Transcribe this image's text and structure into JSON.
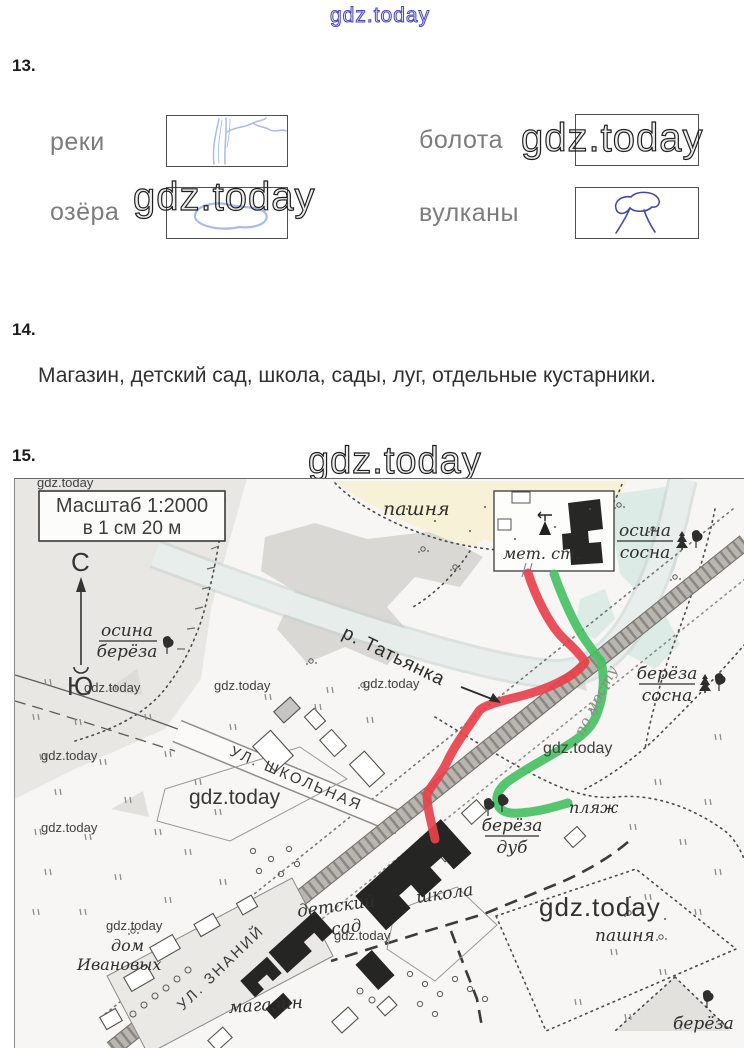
{
  "page": {
    "watermark": "gdz.today"
  },
  "tasks": {
    "t13": {
      "number": "13.",
      "rows": [
        {
          "left_label": "реки",
          "right_label": "болота"
        },
        {
          "left_label": "озёра",
          "right_label": "вулканы"
        }
      ]
    },
    "t14": {
      "number": "14.",
      "answer": "Магазин, детский сад, школа, сады, луг, отдельные кустарники."
    },
    "t15": {
      "number": "15."
    }
  },
  "map": {
    "scale_line1": "Масштаб 1:2000",
    "scale_line2": "в 1 см 20 м",
    "compass": {
      "north": "С",
      "south": "Ю"
    },
    "legends": {
      "osina_bereza": {
        "top": "осина",
        "bottom": "берёза"
      },
      "osina_sosna": {
        "top": "осина",
        "bottom": "сосна"
      },
      "bereza_sosna": {
        "top": "берёза",
        "bottom": "сосна"
      },
      "bereza_dub": {
        "top": "берёза",
        "bottom": "дуб"
      },
      "bereza_corner": "берёза"
    },
    "labels": {
      "pashnya_top": "пашня",
      "pashnya_bottom": "пашня",
      "river": "р. Татьянка",
      "met_st": "мет. ст.",
      "beach": "пляж",
      "school": "школа",
      "kindergarten_1": "детский",
      "kindergarten_2": "сад",
      "shop": "магазин",
      "house_1": "дом",
      "house_2": "Ивановых",
      "street_shkolnaya": "УЛ. ШКОЛЬНАЯ",
      "street_znaniy": "УЛ. ЗНАНИЙ",
      "route_note": "по мосту"
    },
    "colors": {
      "route_red": "#e8414b",
      "route_green": "#46c163"
    }
  }
}
